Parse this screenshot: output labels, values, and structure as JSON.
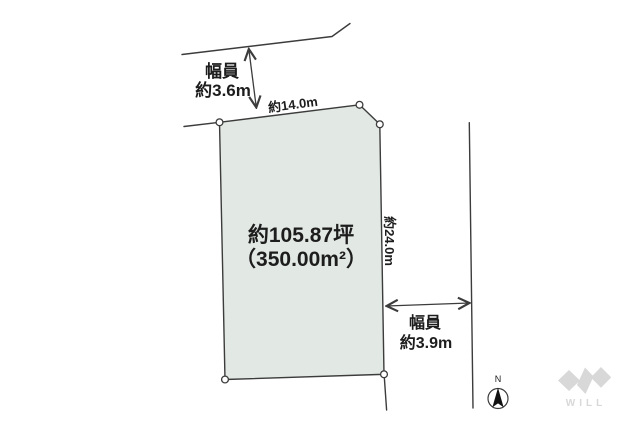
{
  "diagram": {
    "road_top_width": {
      "label_line1": "幅員",
      "label_line2": "約3.6m"
    },
    "edge_top_length": "約14.0m",
    "plot": {
      "area_tsubo": "約105.87坪",
      "area_sqm": "（350.00m²）"
    },
    "edge_right_length": "約24.0m",
    "road_right_width": {
      "label_line1": "幅員",
      "label_line2": "約3.9m"
    },
    "compass": {
      "label": "N"
    },
    "logo": {
      "text": "WILL"
    }
  },
  "colors": {
    "bg": "#ffffff",
    "line": "#3c3c3c",
    "plot-fill": "#e2e8e3",
    "text": "#1d1d1d",
    "logo": "#d8d8d8"
  }
}
